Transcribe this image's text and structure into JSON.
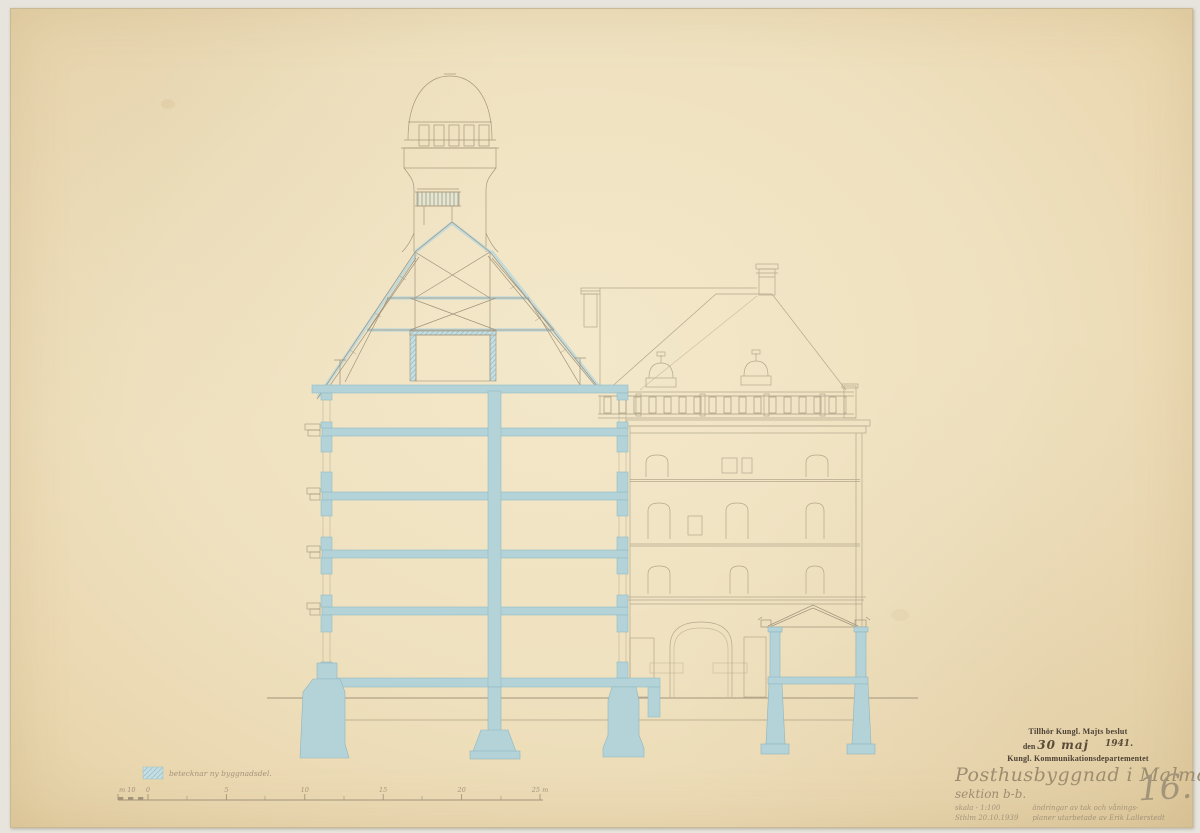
{
  "document": {
    "kind": "archival architectural section drawing",
    "sheet_number": "16."
  },
  "stamp": {
    "line1": "Tillhör Kungl. Majts beslut",
    "prefix": "den",
    "date_handwritten": "30 maj",
    "year_handwritten": "1941.",
    "line3": "Kungl. Kommunikationsdepartementet"
  },
  "title_block": {
    "title": "Posthusbyggnad i Malmö",
    "subtitle": "sektion b-b.",
    "scale_note": "skala - 1:100",
    "place_date": "Sthlm 20.10.1939",
    "revision_note_line1": "ändringar av tak och vånings-",
    "revision_note_line2": "planer utarbetade av Erik Lallerstedt",
    "sheet_number": "16."
  },
  "legend": {
    "label": "betecknar ny byggnadsdel.",
    "swatch_color": "#b8d5da"
  },
  "scale_bar": {
    "prefix_label": "m 10",
    "tick_labels": [
      "0",
      "5",
      "10",
      "15",
      "20",
      "25 m"
    ],
    "pixels_per_5m": 78.4
  },
  "colors": {
    "paper": "#efe1bf",
    "wash_blue": "#b3d3d8",
    "wash_blue_hatch": "#c8dfe3",
    "ink_line": "#a2947c",
    "facade_line": "#b5a88d",
    "stamp_ink": "#4a4034",
    "script_ink": "#9c8d70"
  }
}
